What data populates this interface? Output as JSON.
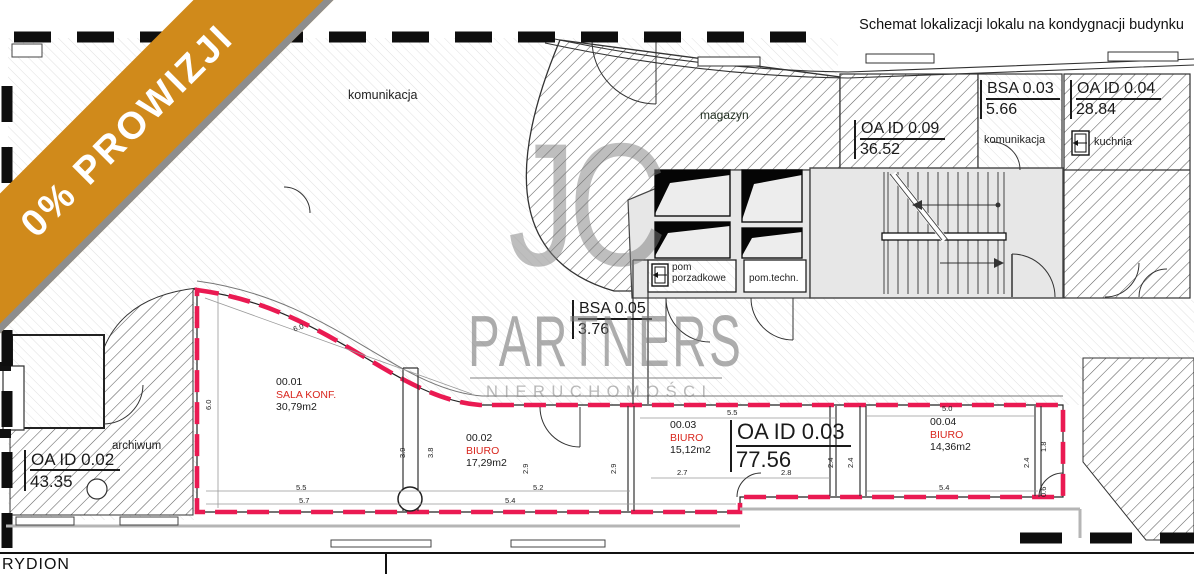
{
  "title": "Schemat lokalizacji lokalu na kondygnacji budynku",
  "ribbon": {
    "label": "0% PROWIZJI"
  },
  "watermark": {
    "logo": "JC",
    "name": "PARTNERS",
    "subtitle": "NIERUCHOMOŚCI"
  },
  "footer": {
    "project": "RYDION"
  },
  "colors": {
    "ribbon_gold": "#D08A1B",
    "ribbon_shadow": "#8D8D8D",
    "unit_boundary_red": "#EA1A52",
    "room_label_red": "#D8261D",
    "watermark_gray": "#9A9A9A"
  },
  "zone_labels": {
    "corridor_main": "komunikacja",
    "storage": "magazyn",
    "archive": "archiwum",
    "kitchen": "kuchnia",
    "corridor_small": "komunikacja",
    "cleaning_room_line1": "pom",
    "cleaning_room_line2": "porzadkowe",
    "technical_room": "pom.techn."
  },
  "area_tags": [
    {
      "id": "OA ID 0.09",
      "value": "36.52"
    },
    {
      "id": "BSA 0.03",
      "value": "5.66"
    },
    {
      "id": "OA ID 0.04",
      "value": "28.84"
    },
    {
      "id": "BSA 0.05",
      "value": "3.76"
    },
    {
      "id": "OA ID 0.03",
      "value": "77.56"
    },
    {
      "id": "OA ID 0.02",
      "value": "43.35"
    }
  ],
  "rooms": [
    {
      "number": "00.01",
      "type": "SALA KONF.",
      "area": "30,79m2"
    },
    {
      "number": "00.02",
      "type": "BIURO",
      "area": "17,29m2"
    },
    {
      "number": "00.03",
      "type": "BIURO",
      "area": "15,12m2"
    },
    {
      "number": "00.04",
      "type": "BIURO",
      "area": "14,36m2"
    }
  ],
  "dimensions": [
    {
      "v": "6.0"
    },
    {
      "v": "6.0"
    },
    {
      "v": "5.5"
    },
    {
      "v": "5.7"
    },
    {
      "v": "5.2"
    },
    {
      "v": "5.4"
    },
    {
      "v": "3.9"
    },
    {
      "v": "3.8"
    },
    {
      "v": "2.9"
    },
    {
      "v": "2.9"
    },
    {
      "v": "5.5"
    },
    {
      "v": "2.7"
    },
    {
      "v": "2.8"
    },
    {
      "v": "2.4"
    },
    {
      "v": "2.4"
    },
    {
      "v": "5.0"
    },
    {
      "v": "5.4"
    },
    {
      "v": "1.8"
    },
    {
      "v": "2.4"
    },
    {
      "v": "0.6"
    }
  ]
}
